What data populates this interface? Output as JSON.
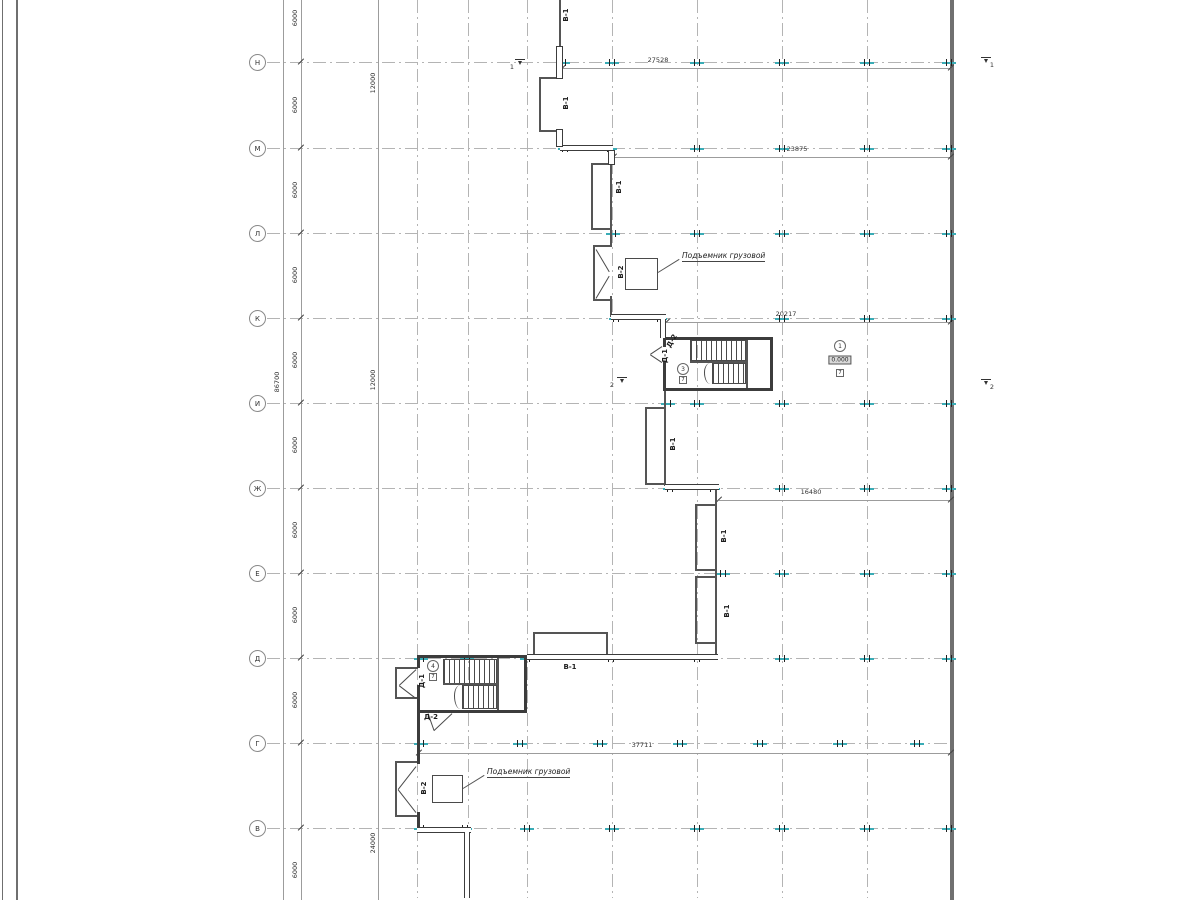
{
  "drawing": {
    "type": "architectural floor plan (CAD)",
    "lift_label": "Подъемник грузовой"
  },
  "axes": {
    "rows": [
      {
        "label": "Н",
        "y": 62
      },
      {
        "label": "М",
        "y": 148
      },
      {
        "label": "Л",
        "y": 233
      },
      {
        "label": "К",
        "y": 318
      },
      {
        "label": "И",
        "y": 403
      },
      {
        "label": "Ж",
        "y": 488
      },
      {
        "label": "Е",
        "y": 573
      },
      {
        "label": "Д",
        "y": 658
      },
      {
        "label": "Г",
        "y": 743
      },
      {
        "label": "В",
        "y": 828
      }
    ],
    "circle_x": 257,
    "row_x1": 267,
    "row_x2": 951,
    "columns_x": [
      417,
      468,
      527,
      612,
      697,
      782,
      867
    ],
    "right_edge_x": 950
  },
  "frame": {
    "lines": [
      [
        2,
        0,
        1,
        900
      ],
      [
        16,
        0,
        1.5,
        900
      ]
    ],
    "right_wall": [
      950,
      0,
      4,
      900
    ]
  },
  "v_chains": {
    "lines_x": [
      283,
      301,
      378
    ],
    "total_label": {
      "value": "86700",
      "x": 277,
      "y": 382
    },
    "chain6000": {
      "value": "6000",
      "x": 295,
      "ys": [
        18,
        105,
        190,
        275,
        360,
        445,
        530,
        615,
        700,
        870
      ],
      "ticks_y": [
        62,
        148,
        233,
        318,
        403,
        488,
        573,
        658,
        743,
        828
      ]
    },
    "chain12000": [
      {
        "value": "12000",
        "x": 373,
        "y": 83
      },
      {
        "value": "12000",
        "x": 373,
        "y": 380
      },
      {
        "value": "24000",
        "x": 373,
        "y": 843
      }
    ]
  },
  "h_dims": [
    {
      "value": "27528",
      "y": 68,
      "x1": 563,
      "x2": 951,
      "lx": 658,
      "ly": 60
    },
    {
      "value": "23875",
      "y": 157,
      "x1": 614,
      "x2": 951,
      "lx": 797,
      "ly": 149
    },
    {
      "value": "20217",
      "y": 322,
      "x1": 667,
      "x2": 951,
      "lx": 786,
      "ly": 314
    },
    {
      "value": "16480",
      "y": 500,
      "x1": 719,
      "x2": 951,
      "lx": 811,
      "ly": 492
    },
    {
      "value": "37711",
      "y": 753,
      "x1": 419,
      "x2": 951,
      "lx": 642,
      "ly": 745
    }
  ],
  "col_ticks": [
    {
      "y": 62,
      "xs": [
        563,
        612,
        697,
        782,
        867,
        949
      ]
    },
    {
      "y": 148,
      "xs": [
        565,
        610,
        697,
        782,
        867,
        949
      ]
    },
    {
      "y": 233,
      "xs": [
        613,
        697,
        782,
        867,
        949
      ]
    },
    {
      "y": 318,
      "xs": [
        616,
        660,
        782,
        867,
        949
      ]
    },
    {
      "y": 403,
      "xs": [
        668,
        697,
        782,
        867,
        949
      ]
    },
    {
      "y": 488,
      "xs": [
        670,
        713,
        782,
        867,
        949
      ]
    },
    {
      "y": 573,
      "xs": [
        723,
        782,
        867,
        949
      ]
    },
    {
      "y": 658,
      "xs": [
        421,
        467,
        527,
        611,
        697,
        782,
        867,
        949
      ]
    },
    {
      "y": 743,
      "xs": [
        421,
        520,
        600,
        680,
        760,
        840,
        917
      ]
    },
    {
      "y": 828,
      "xs": [
        421,
        465,
        527,
        612,
        697,
        782,
        867,
        949
      ]
    }
  ],
  "walls_thin": [
    [
      559,
      0,
      2,
      47
    ],
    [
      539,
      77,
      22,
      1.5
    ],
    [
      539,
      77,
      1.5,
      55
    ],
    [
      539,
      130,
      22,
      1.5
    ],
    [
      591,
      163,
      21,
      1.5
    ],
    [
      591,
      163,
      1.5,
      67
    ],
    [
      591,
      228,
      21,
      1.5
    ],
    [
      610,
      163,
      1.5,
      84
    ],
    [
      593,
      245,
      18,
      1.5
    ],
    [
      593,
      245,
      1.5,
      56
    ],
    [
      593,
      299,
      18,
      1.5
    ],
    [
      610,
      296,
      1.5,
      21
    ],
    [
      664,
      391,
      1.5,
      95
    ],
    [
      645,
      407,
      21,
      1.5
    ],
    [
      645,
      407,
      1.5,
      78
    ],
    [
      645,
      483,
      21,
      1.5
    ],
    [
      715,
      490,
      1.5,
      166
    ],
    [
      695,
      504,
      21,
      1.5
    ],
    [
      695,
      504,
      1.5,
      67
    ],
    [
      695,
      569,
      21,
      1.5
    ],
    [
      695,
      576,
      21,
      1.5
    ],
    [
      695,
      576,
      1.5,
      68
    ],
    [
      695,
      642,
      21,
      1.5
    ],
    [
      533,
      632,
      1.5,
      24
    ],
    [
      533,
      632,
      75,
      1.5
    ],
    [
      606,
      632,
      1.5,
      24
    ],
    [
      395,
      667,
      1.5,
      32
    ],
    [
      395,
      667,
      23,
      1.5
    ],
    [
      395,
      697,
      23,
      1.5
    ],
    [
      395,
      761,
      1.5,
      56
    ],
    [
      395,
      761,
      23,
      1.5
    ],
    [
      395,
      815,
      23,
      1.5
    ],
    [
      746,
      339,
      1.5,
      51
    ],
    [
      497,
      658,
      1.5,
      53
    ]
  ],
  "walls_thick": [
    [
      665,
      337,
      108,
      3
    ],
    [
      770,
      337,
      3,
      54
    ],
    [
      665,
      388,
      108,
      3
    ],
    [
      663,
      337,
      3,
      10
    ],
    [
      663,
      361,
      3,
      30
    ],
    [
      417,
      655,
      110,
      3
    ],
    [
      524,
      655,
      3,
      58
    ],
    [
      417,
      710,
      110,
      3
    ],
    [
      417,
      655,
      3,
      13
    ],
    [
      417,
      685,
      3,
      28
    ],
    [
      417,
      712,
      3,
      52
    ],
    [
      417,
      812,
      3,
      18
    ]
  ],
  "dwall_h": [
    [
      560,
      145,
      53
    ],
    [
      611,
      314,
      55
    ],
    [
      665,
      484,
      54
    ],
    [
      527,
      654,
      191
    ],
    [
      417,
      827,
      54
    ]
  ],
  "dwall_v": [
    [
      660,
      319,
      19
    ],
    [
      464,
      832,
      66
    ]
  ],
  "windows": [
    [
      556,
      46,
      7,
      33
    ],
    [
      556,
      129,
      7,
      18
    ],
    [
      608,
      150,
      7,
      15
    ]
  ],
  "lifts": [
    {
      "box": [
        625,
        258,
        33,
        32
      ],
      "leader": [
        658,
        272,
        679,
        259
      ],
      "text": "Подъемник грузовой",
      "tx": 682,
      "ty": 251
    },
    {
      "box": [
        432,
        775,
        31,
        28
      ],
      "leader": [
        463,
        788,
        484,
        775
      ],
      "text": "Подъемник грузовой",
      "tx": 487,
      "ty": 767
    }
  ],
  "stairs": {
    "flights": [
      [
        690,
        340,
        56,
        21
      ],
      [
        712,
        363,
        34,
        21
      ],
      [
        443,
        659,
        54,
        25
      ],
      [
        462,
        685,
        35,
        24
      ]
    ],
    "midlines": [
      [
        690,
        361,
        56,
        1.5
      ],
      [
        443,
        683,
        54,
        1.5
      ]
    ],
    "breaks": [
      [
        704,
        363,
        9,
        21
      ],
      [
        454,
        685,
        9,
        24
      ]
    ]
  },
  "diagonals": [
    [
      596,
      249,
      609,
      271
    ],
    [
      596,
      298,
      609,
      276
    ],
    [
      662,
      346,
      650,
      354
    ],
    [
      662,
      362,
      650,
      354
    ],
    [
      416,
      669,
      399,
      685
    ],
    [
      416,
      698,
      399,
      685
    ],
    [
      452,
      713,
      434,
      730
    ],
    [
      428,
      713,
      434,
      730
    ],
    [
      416,
      766,
      398,
      789
    ],
    [
      416,
      812,
      398,
      789
    ]
  ],
  "labels": [
    {
      "text": "В-1",
      "x": 566,
      "y": 15,
      "rot": -90
    },
    {
      "text": "В-1",
      "x": 566,
      "y": 103,
      "rot": -90
    },
    {
      "text": "В-1",
      "x": 619,
      "y": 187,
      "rot": -90
    },
    {
      "text": "В-1",
      "x": 673,
      "y": 444,
      "rot": -90
    },
    {
      "text": "В-1",
      "x": 724,
      "y": 536,
      "rot": -90
    },
    {
      "text": "В-1",
      "x": 727,
      "y": 611,
      "rot": -90
    },
    {
      "text": "В-1",
      "x": 570,
      "y": 667,
      "rot": 0
    },
    {
      "text": "В-2",
      "x": 621,
      "y": 272,
      "rot": -90
    },
    {
      "text": "В-2",
      "x": 424,
      "y": 788,
      "rot": -90
    },
    {
      "text": "Д-2",
      "x": 672,
      "y": 341,
      "rot": -60
    },
    {
      "text": "Д-1",
      "x": 665,
      "y": 356,
      "rot": -90
    },
    {
      "text": "Д-1",
      "x": 422,
      "y": 681,
      "rot": -90
    },
    {
      "text": "Д-2",
      "x": 431,
      "y": 717,
      "rot": 0
    }
  ],
  "rooms": [
    {
      "num": "3",
      "cx": 683,
      "cy": 369,
      "tag": "7",
      "tgy": 380
    },
    {
      "num": "4",
      "cx": 433,
      "cy": 666,
      "tag": "7",
      "tgy": 677
    },
    {
      "num": "1",
      "cx": 840,
      "cy": 346,
      "elev": "0.000",
      "evy": 360,
      "tag": "7",
      "tgy": 373
    }
  ],
  "sections": [
    {
      "num": "1",
      "x": 520,
      "y": 59,
      "lx": 512,
      "ly": 64
    },
    {
      "num": "1",
      "x": 986,
      "y": 57,
      "lx": 992,
      "ly": 62
    },
    {
      "num": "2",
      "x": 622,
      "y": 377,
      "lx": 612,
      "ly": 382
    },
    {
      "num": "2",
      "x": 986,
      "y": 379,
      "lx": 992,
      "ly": 384
    }
  ]
}
